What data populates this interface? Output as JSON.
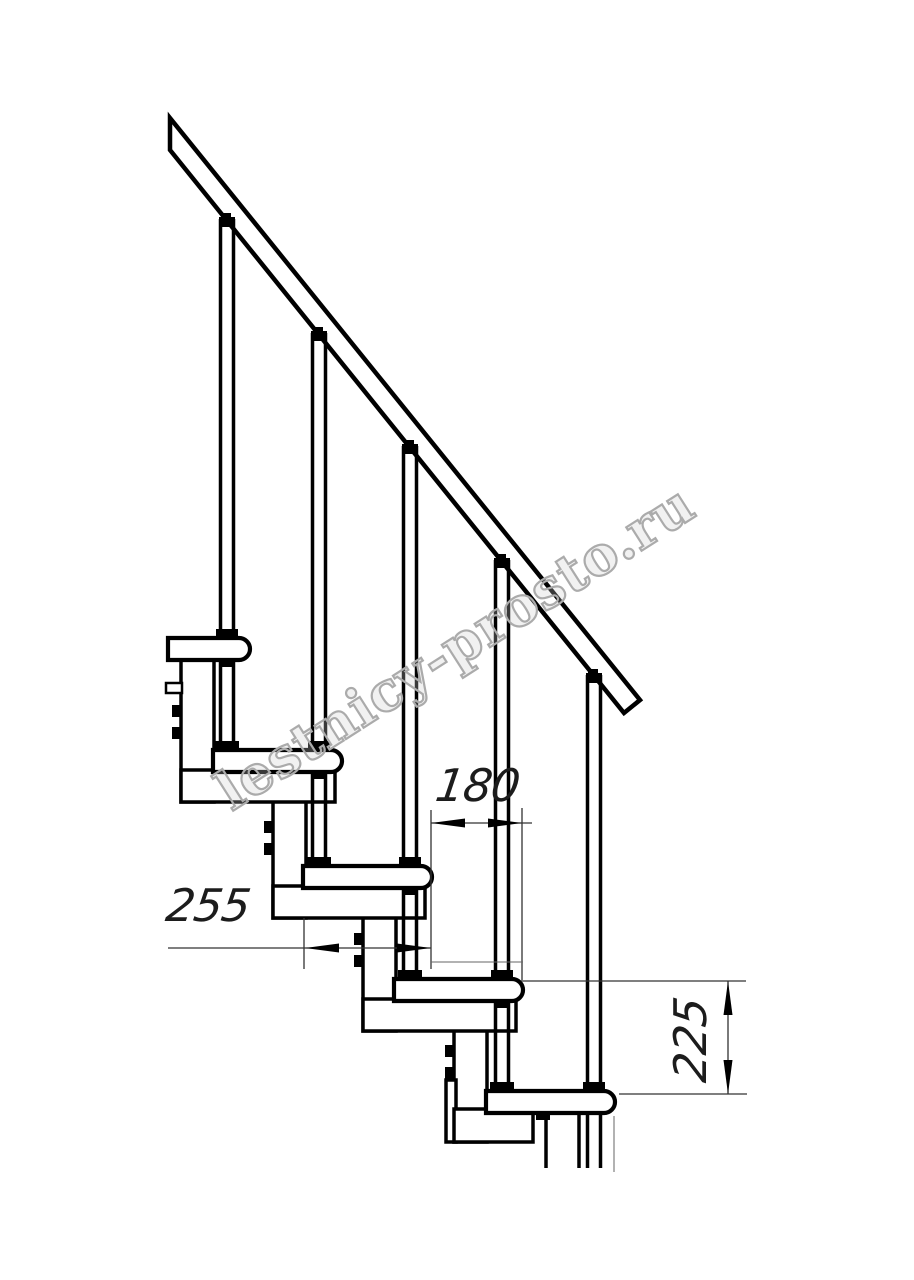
{
  "watermark": {
    "text": "lestnicy-prosto.ru"
  },
  "dimensions": {
    "tread_depth": {
      "value": "255",
      "unit": "mm"
    },
    "step_run": {
      "value": "180",
      "unit": "mm"
    },
    "step_height": {
      "value": "225",
      "unit": "mm"
    }
  }
}
